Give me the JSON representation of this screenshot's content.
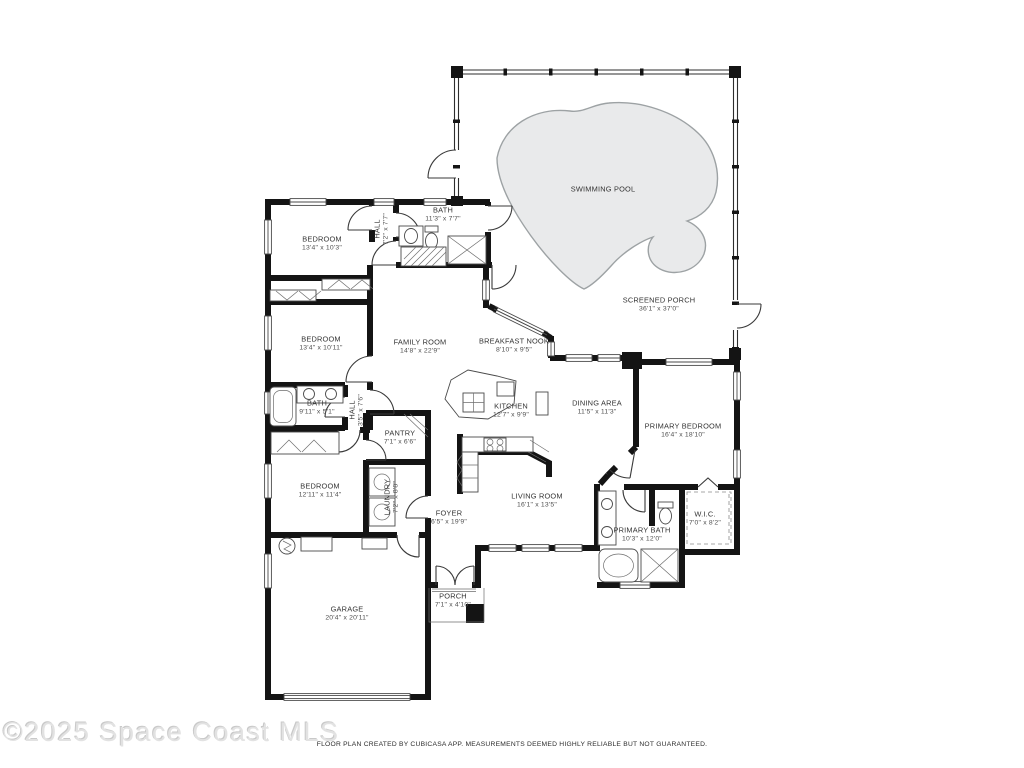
{
  "watermark": "©2025 Space Coast MLS",
  "footer_disclaimer": "FLOOR PLAN CREATED BY CUBICASA APP. MEASUREMENTS DEEMED HIGHLY RELIABLE BUT NOT GUARANTEED.",
  "colors": {
    "wall": "#141414",
    "pool_fill": "#e9eaeb",
    "pool_stroke": "#9da2a4",
    "watermark_gray": "#e2e2e2"
  },
  "rooms": {
    "swimming_pool": {
      "name": "SWIMMING POOL",
      "dims": ""
    },
    "screened_porch": {
      "name": "SCREENED PORCH",
      "dims": "36'1\" x 37'0\""
    },
    "bedroom_top": {
      "name": "BEDROOM",
      "dims": "13'4\" x 10'3\""
    },
    "hall_top": {
      "name": "HALL",
      "dims": "7'2\" x 7'7\""
    },
    "bath_top": {
      "name": "BATH",
      "dims": "11'3\" x 7'7\""
    },
    "bedroom_mid": {
      "name": "BEDROOM",
      "dims": "13'4\" x 10'11\""
    },
    "family_room": {
      "name": "FAMILY ROOM",
      "dims": "14'8\" x 22'9\""
    },
    "breakfast_nook": {
      "name": "BREAKFAST NOOK",
      "dims": "8'10\" x 9'5\""
    },
    "bath_mid": {
      "name": "BATH",
      "dims": "9'11\" x 5'1\""
    },
    "hall_mid": {
      "name": "HALL",
      "dims": "3'5\" x 7'6\""
    },
    "kitchen": {
      "name": "KITCHEN",
      "dims": "12'7\" x 9'9\""
    },
    "dining_area": {
      "name": "DINING AREA",
      "dims": "11'5\" x 11'3\""
    },
    "primary_bedroom": {
      "name": "PRIMARY BEDROOM",
      "dims": "16'4\" x 18'10\""
    },
    "pantry": {
      "name": "PANTRY",
      "dims": "7'1\" x 6'6\""
    },
    "bedroom_bottom": {
      "name": "BEDROOM",
      "dims": "12'11\" x 11'4\""
    },
    "laundry": {
      "name": "LAUNDRY",
      "dims": "7'2\" x 8'8\""
    },
    "foyer": {
      "name": "FOYER",
      "dims": "6'5\" x 19'9\""
    },
    "living_room": {
      "name": "LIVING ROOM",
      "dims": "16'1\" x 13'5\""
    },
    "primary_bath": {
      "name": "PRIMARY BATH",
      "dims": "10'3\" x 12'0\""
    },
    "wic": {
      "name": "W.I.C.",
      "dims": "7'0\" x 8'2\""
    },
    "garage": {
      "name": "GARAGE",
      "dims": "20'4\" x 20'11\""
    },
    "porch": {
      "name": "PORCH",
      "dims": "7'1\" x 4'10\""
    }
  }
}
